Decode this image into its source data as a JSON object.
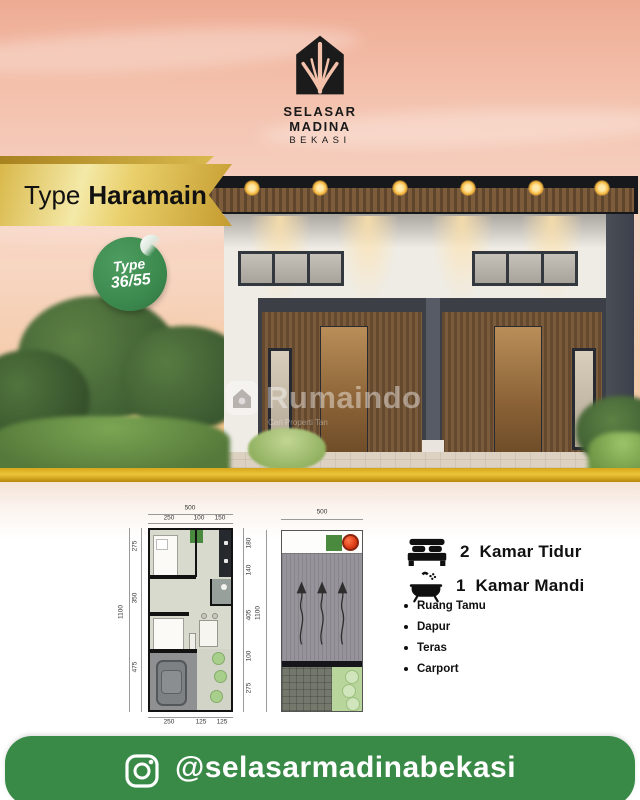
{
  "logo": {
    "title": "SELASAR MADINA",
    "subtitle": "BEKASI"
  },
  "banner": {
    "prefix": "Type",
    "name": "Haramain"
  },
  "badge": {
    "line1": "Type",
    "line2": "36/55"
  },
  "watermark": {
    "title": "Rumaindo",
    "tagline": "Cari Properti Tan"
  },
  "plans": {
    "floor": {
      "width_total": "500",
      "height_total": "1100",
      "top": [
        "250",
        "100",
        "150"
      ],
      "bottom": [
        "250",
        "125",
        "125"
      ],
      "left": [
        "275",
        "350",
        "475"
      ],
      "right": [
        "180",
        "140",
        "405",
        "100",
        "275"
      ]
    },
    "roof": {
      "width_total": "500",
      "height_total": "1100"
    }
  },
  "specs": {
    "bedrooms_count": "2",
    "bedrooms_label": "Kamar Tidur",
    "bathrooms_count": "1",
    "bathrooms_label": "Kamar Mandi",
    "features": [
      "Ruang Tamu",
      "Dapur",
      "Teras",
      "Carport"
    ]
  },
  "footer": {
    "handle": "@selasarmadinabekasi"
  },
  "colors": {
    "gold": "#d4a62a",
    "badge_green": "#3c8a4e",
    "footer_green": "#3a8a47",
    "roof_dark": "#17181c",
    "sky_peach": "#f3c0ab"
  }
}
